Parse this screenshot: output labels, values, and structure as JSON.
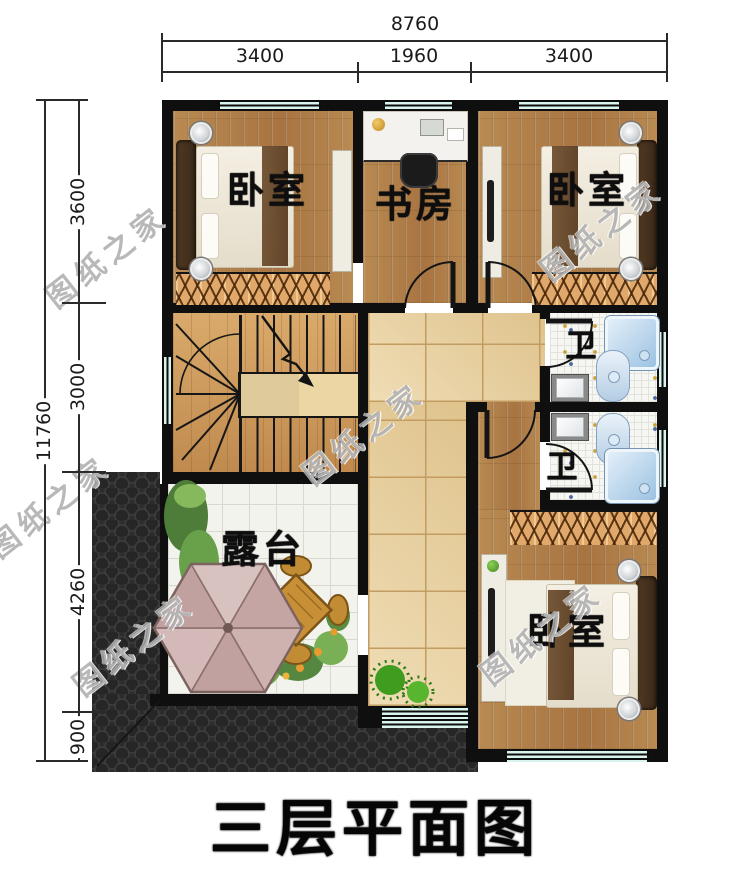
{
  "title": {
    "text": "三层平面图"
  },
  "watermark": {
    "text": "图纸之家"
  },
  "dimensions": {
    "top": {
      "overall": "8760",
      "seg1": "3400",
      "seg2": "1960",
      "seg3": "3400"
    },
    "left": {
      "overall": "11760",
      "seg1": "3600",
      "seg2": "3000",
      "seg3": "4260",
      "seg4": "900"
    }
  },
  "rooms": {
    "bedroom_top_left": {
      "label": "卧室"
    },
    "study": {
      "label": "书房"
    },
    "bedroom_top_right": {
      "label": "卧室"
    },
    "bath_upper": {
      "label": "卫"
    },
    "bath_lower": {
      "label": "卫"
    },
    "terrace": {
      "label": "露台"
    },
    "bedroom_bottom_right": {
      "label": "卧室"
    }
  },
  "colors": {
    "wall": "#0f0f0f",
    "window_glass": "#d9f3ee",
    "wood_floor": "#b08048",
    "hall_tile": "#ead09a",
    "terrace_tile": "#f3f3ee",
    "roof": "#2c2c2c",
    "shower_blue": "#9cc2e2",
    "wardrobe_hatch": "#e0a96b"
  }
}
